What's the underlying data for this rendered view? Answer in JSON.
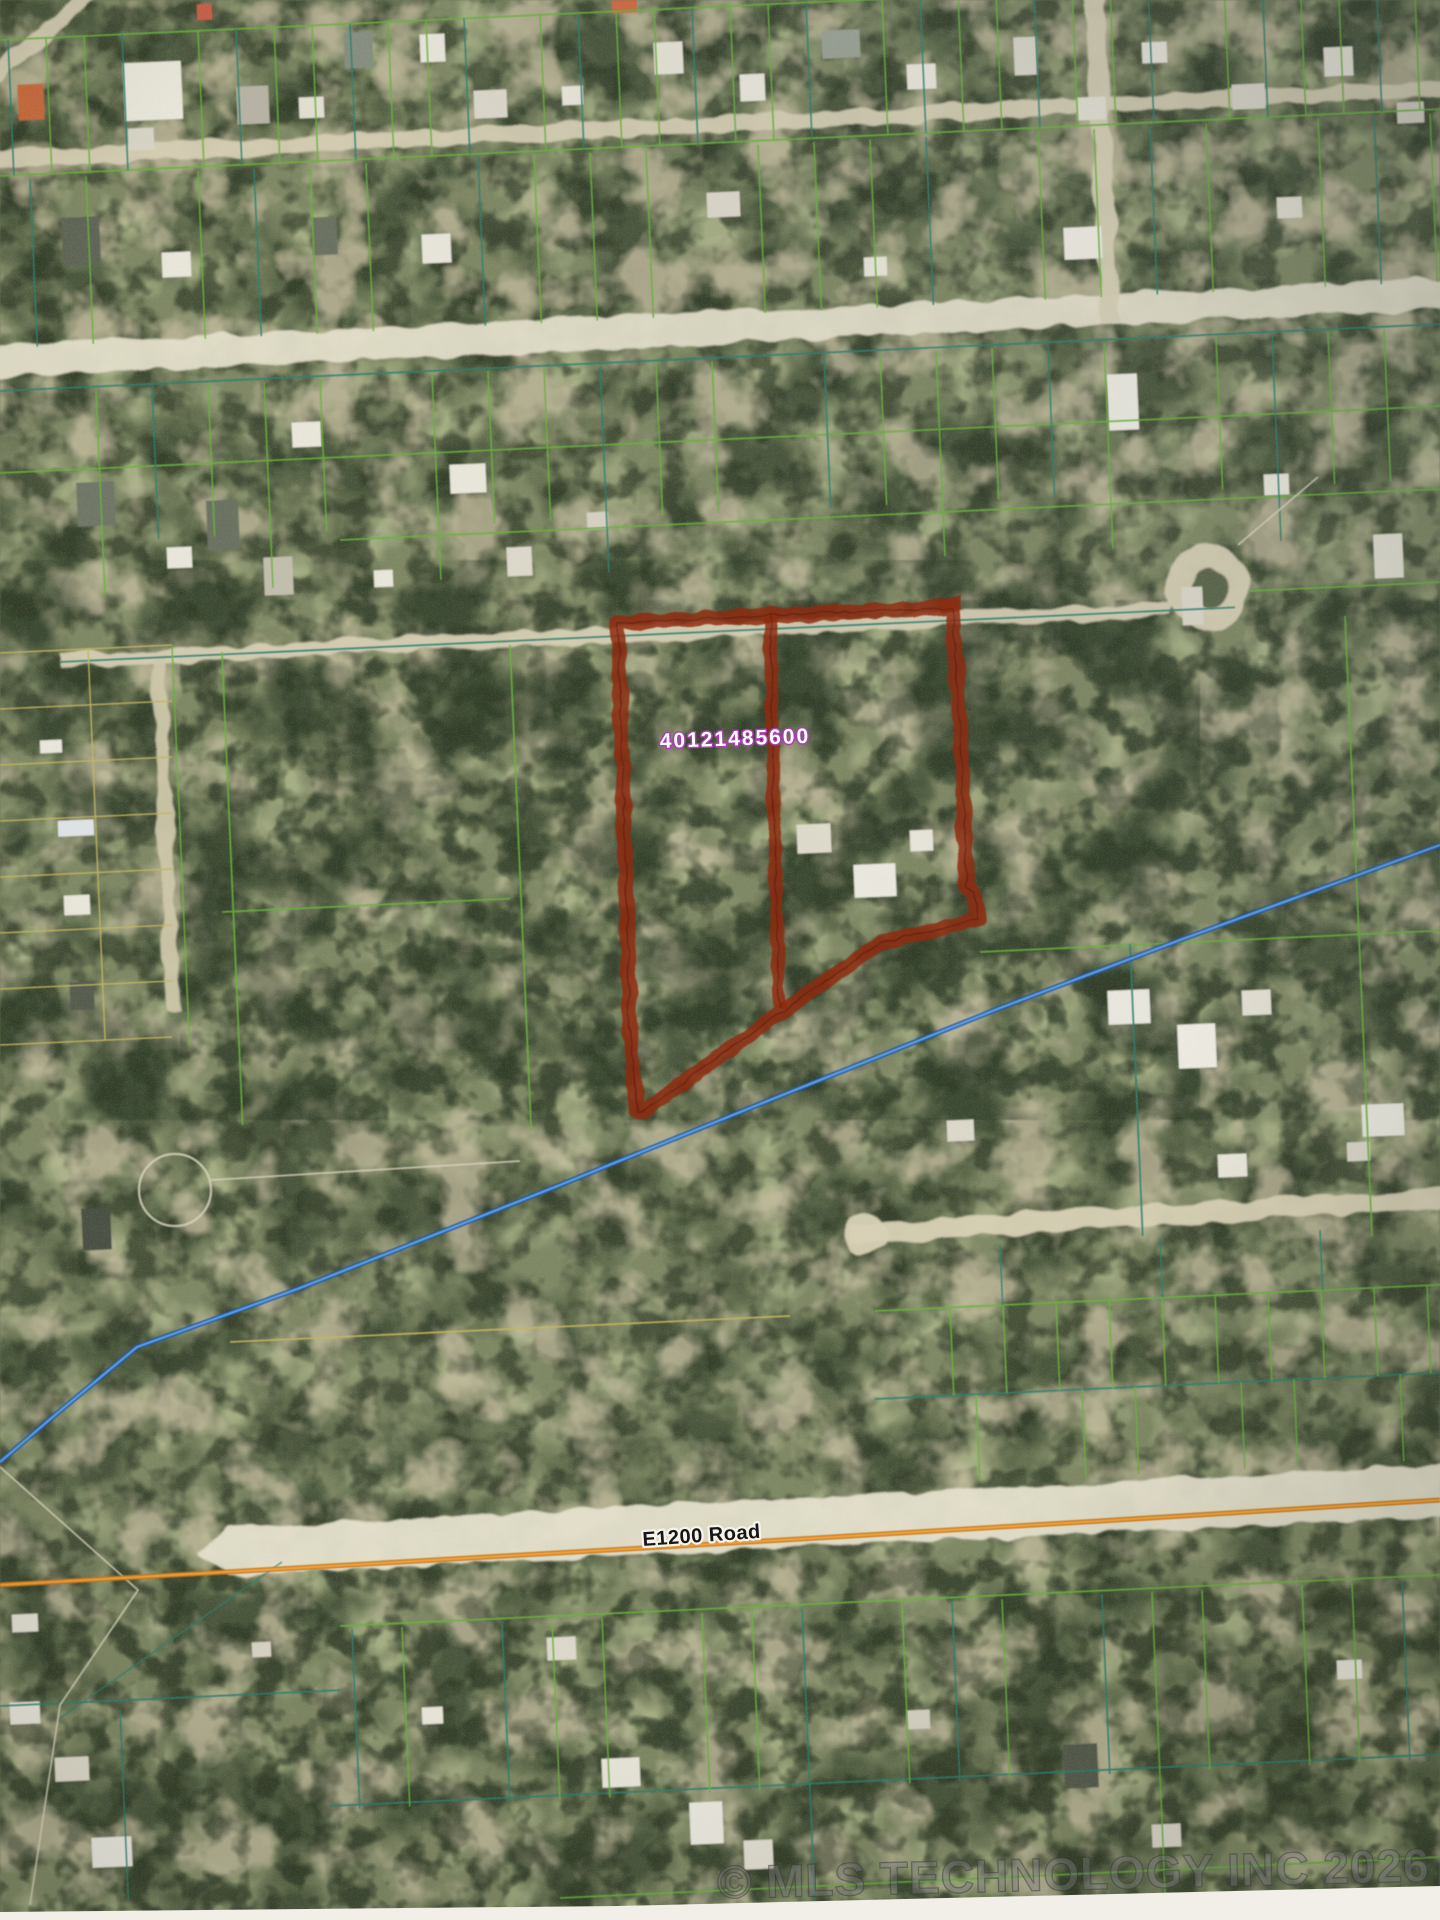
{
  "map": {
    "type": "aerial-parcel-map",
    "parcel": {
      "id": "40121485600",
      "outline_points": "618,623 952,607 962,760 966,886 975,893 978,920 880,943 779,1013 646,1110 638,1112 631,1055",
      "divider_points": "770,616 774,810 779,1008",
      "corner_marker_points": "938,598 960,595 962,609 940,612",
      "outline_color": "#8e2a0c",
      "label_fill": "#ffffff",
      "label_stroke": "#a93fb0"
    },
    "creek": {
      "points": "1440,845 1180,940 1000,1008 760,1104 560,1185 300,1288 137,1347 55,1415 0,1462",
      "color": "#1d55a8",
      "highlight": "#5f9fe0"
    },
    "road_line": {
      "points": "0,1585 400,1562 800,1539 1100,1521 1440,1500",
      "color": "#c9781c",
      "highlight": "#f0a43c"
    },
    "road_label": "E1200 Road",
    "watermark": "© MLS TECHNOLOGY INC 2026",
    "colors": {
      "grid_green": "#69b13e",
      "grid_teal": "#2f7f6d",
      "grid_khaki": "#c3b65e",
      "boundary_white": "#d8d3bb",
      "road_fill": "#d6cfb4"
    }
  }
}
